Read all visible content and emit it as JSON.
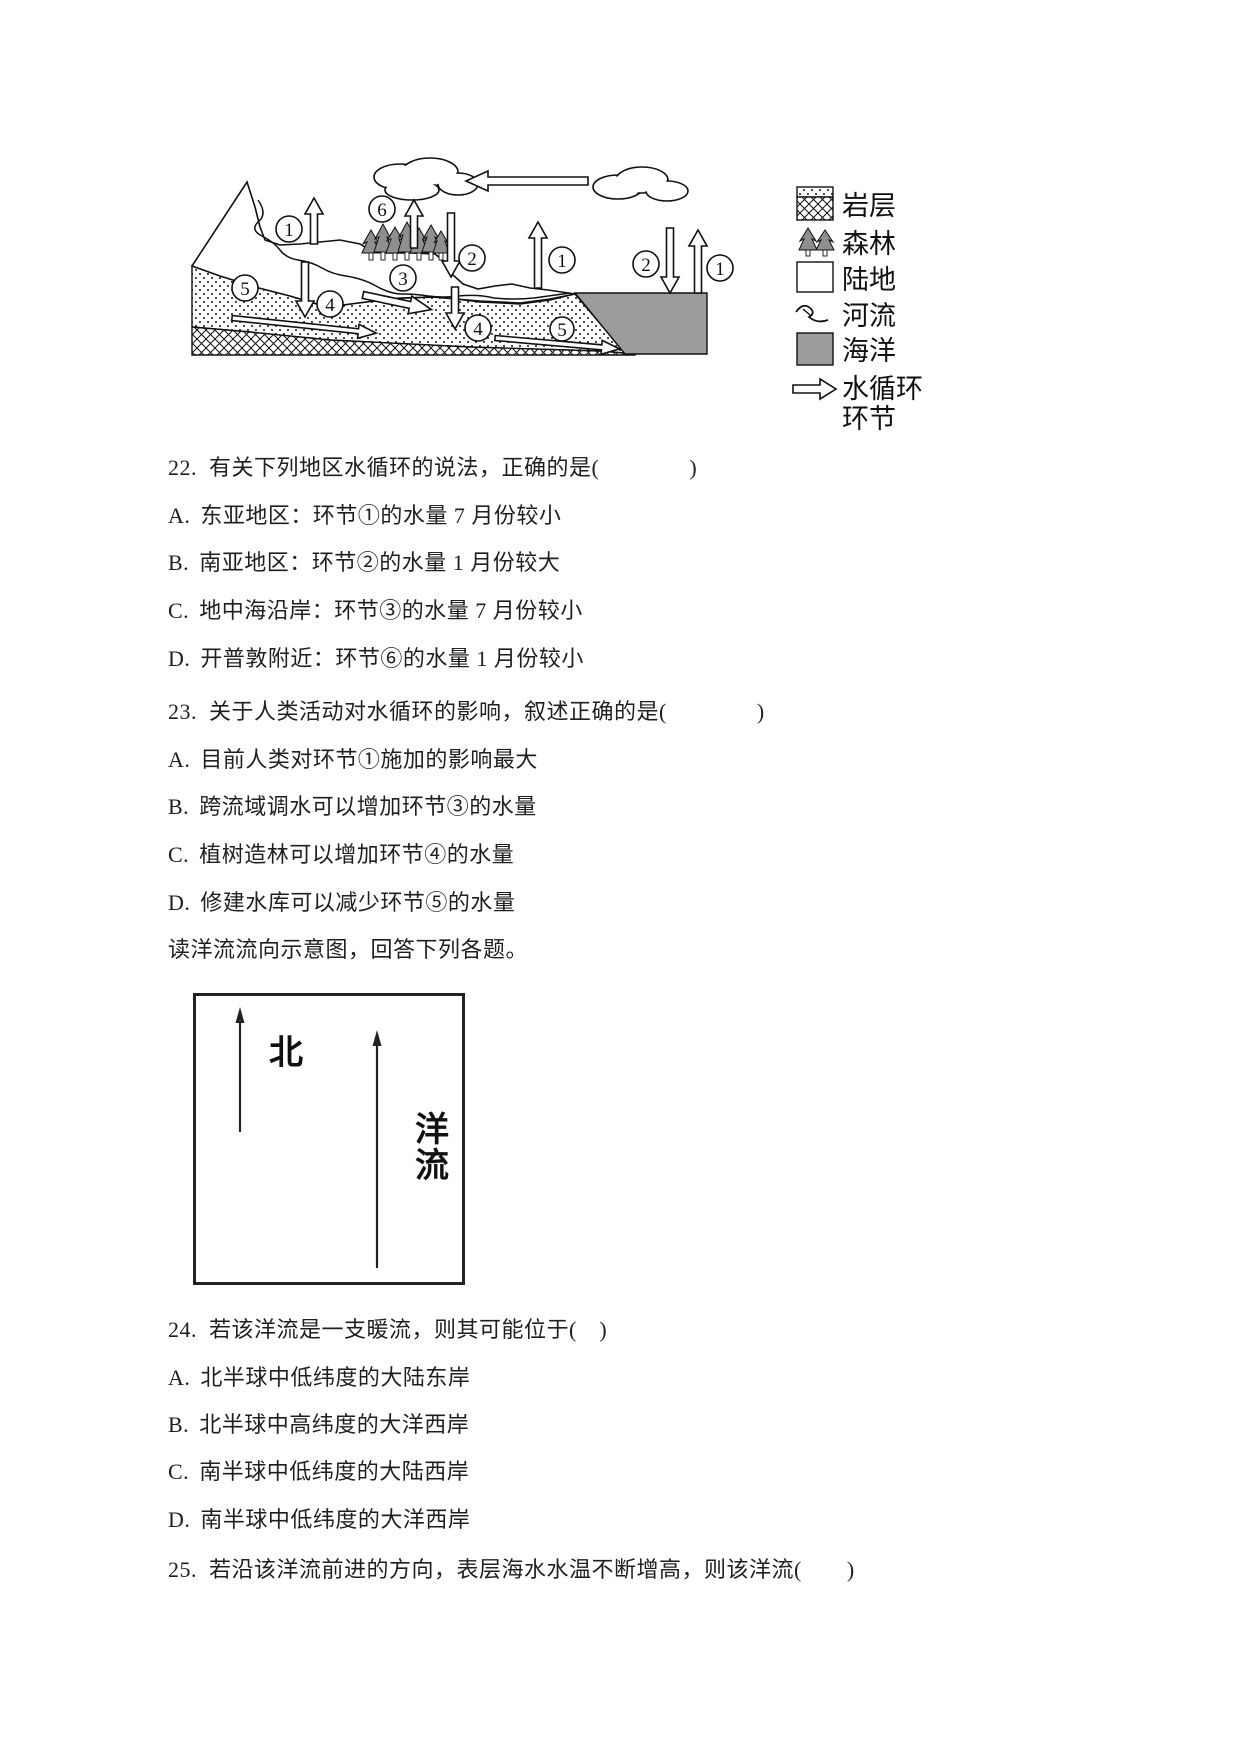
{
  "page": {
    "background": "#ffffff"
  },
  "figure1": {
    "title_hint": "water-cycle-cross-section",
    "numbers": [
      "1",
      "2",
      "3",
      "4",
      "5",
      "6"
    ],
    "legend": [
      {
        "key": "rock-layer",
        "label": "岩层"
      },
      {
        "key": "forest",
        "label": "森林"
      },
      {
        "key": "land",
        "label": "陆地"
      },
      {
        "key": "river",
        "label": "河流"
      },
      {
        "key": "ocean",
        "label": "海洋"
      },
      {
        "key": "water-cycle-link",
        "label_line1": "水循环",
        "label_line2": "环节"
      }
    ],
    "colors": {
      "ocean": "#9c9c9c",
      "tree": "#8f8f8f",
      "ink": "#111111"
    }
  },
  "questions": {
    "q22": {
      "number": "22.",
      "stem": "有关下列地区水循环的说法，正确的是(　　　　)",
      "options": [
        {
          "label": "A.",
          "text": "东亚地区：环节①的水量 7 月份较小"
        },
        {
          "label": "B.",
          "text": "南亚地区：环节②的水量 1 月份较大"
        },
        {
          "label": "C.",
          "text": "地中海沿岸：环节③的水量 7 月份较小"
        },
        {
          "label": "D.",
          "text": "开普敦附近：环节⑥的水量 1 月份较小"
        }
      ]
    },
    "q23": {
      "number": "23.",
      "stem": "关于人类活动对水循环的影响，叙述正确的是(　　　　)",
      "options": [
        {
          "label": "A.",
          "text": "目前人类对环节①施加的影响最大"
        },
        {
          "label": "B.",
          "text": "跨流域调水可以增加环节③的水量"
        },
        {
          "label": "C.",
          "text": "植树造林可以增加环节④的水量"
        },
        {
          "label": "D.",
          "text": "修建水库可以减少环节⑤的水量"
        }
      ]
    },
    "passage": "读洋流流向示意图，回答下列各题。",
    "q24": {
      "number": "24.",
      "stem": "若该洋流是一支暖流，则其可能位于(　)",
      "options": [
        {
          "label": "A.",
          "text": "北半球中低纬度的大陆东岸"
        },
        {
          "label": "B.",
          "text": "北半球中高纬度的大洋西岸"
        },
        {
          "label": "C.",
          "text": "南半球中低纬度的大陆西岸"
        },
        {
          "label": "D.",
          "text": "南半球中低纬度的大洋西岸"
        }
      ]
    },
    "q25": {
      "number": "25.",
      "stem": "若沿该洋流前进的方向，表层海水水温不断增高，则该洋流(　　)"
    }
  },
  "figure2": {
    "north_label": "北",
    "current_char1": "洋",
    "current_char2": "流"
  }
}
